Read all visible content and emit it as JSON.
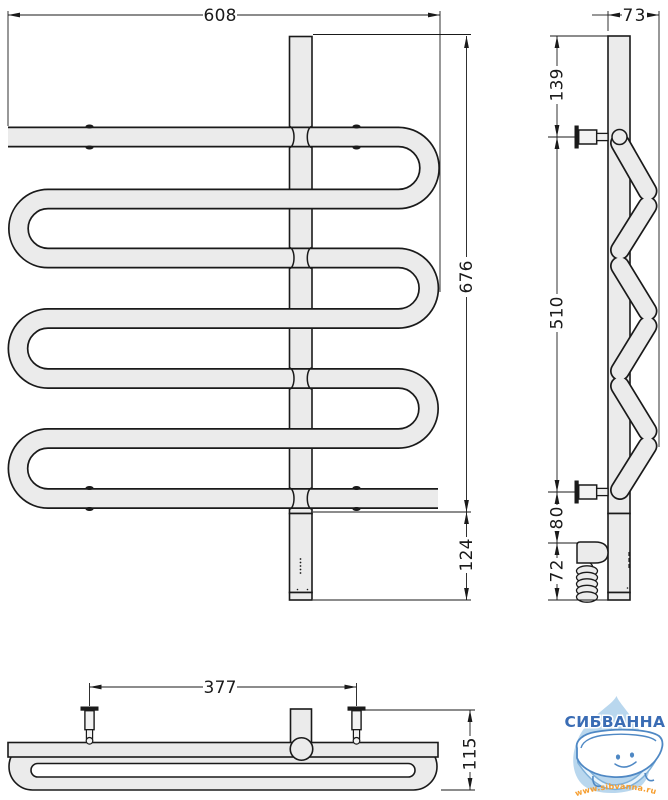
{
  "title": "towel-rail-technical-drawing",
  "dims": {
    "front_width": "608",
    "front_height": "676",
    "front_bottom": "124",
    "side_depth": "73",
    "side_top": "139",
    "side_span": "510",
    "side_lower": "80",
    "side_bottom": "72",
    "plan_span": "377",
    "plan_depth": "115"
  },
  "logo": {
    "brand": "СИБВАННА",
    "website": "www.sibvanna.ru"
  },
  "colors": {
    "tube_fill": "#ebebeb",
    "outline": "#1a1a1a",
    "dim_line": "#1a1a1a",
    "brand_blue": "#3a6cb4",
    "drop_blue": "#b9d7ee",
    "url_orange": "#f59d2e"
  }
}
